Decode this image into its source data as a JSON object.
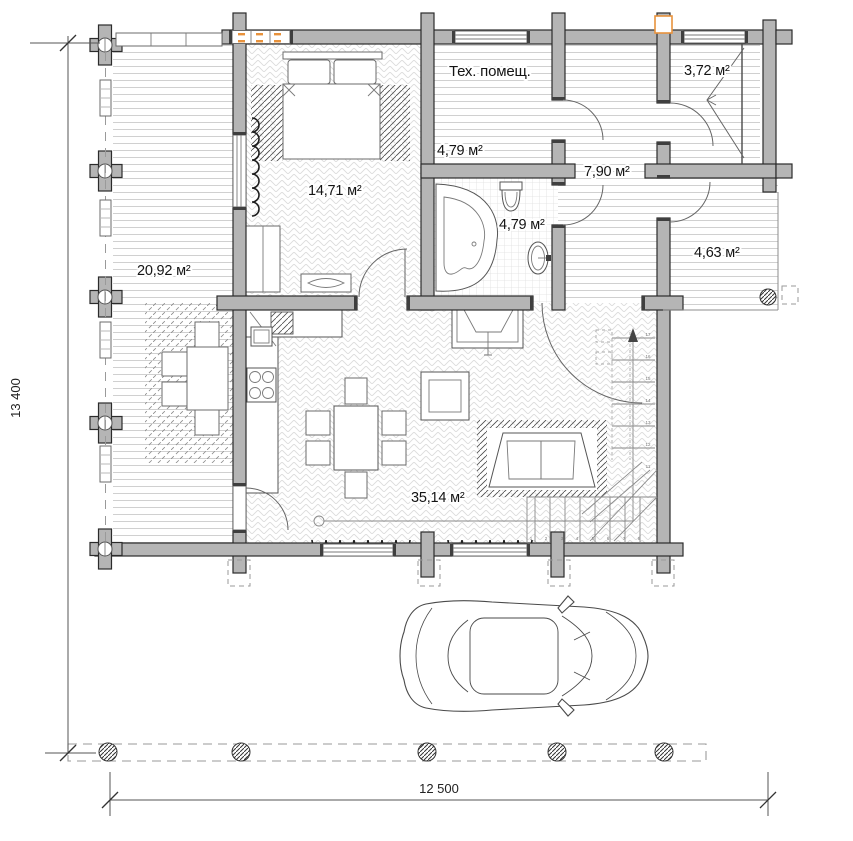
{
  "rooms": {
    "terrace": {
      "area": "20,92 м²"
    },
    "bedroom": {
      "area": "14,71 м²"
    },
    "tech": {
      "name": "Тех. помещ.",
      "area": "4,79 м²"
    },
    "hall": {
      "area": "7,90 м²"
    },
    "bath": {
      "area": "4,79 м²"
    },
    "shower": {
      "area": "3,72 м²"
    },
    "porch": {
      "area": "4,63 м²"
    },
    "living": {
      "area": "35,14 м²"
    }
  },
  "dimensions": {
    "height": "13 400",
    "width": "12 500"
  },
  "stairs": {
    "upper": [
      "17",
      "16",
      "15",
      "14",
      "13",
      "12",
      "11"
    ],
    "lower": [
      "1",
      "2",
      "3",
      "4",
      "5",
      "6",
      "7",
      "8"
    ]
  },
  "colors": {
    "wall": "#b5b5b5",
    "accent": "#e8923c"
  }
}
